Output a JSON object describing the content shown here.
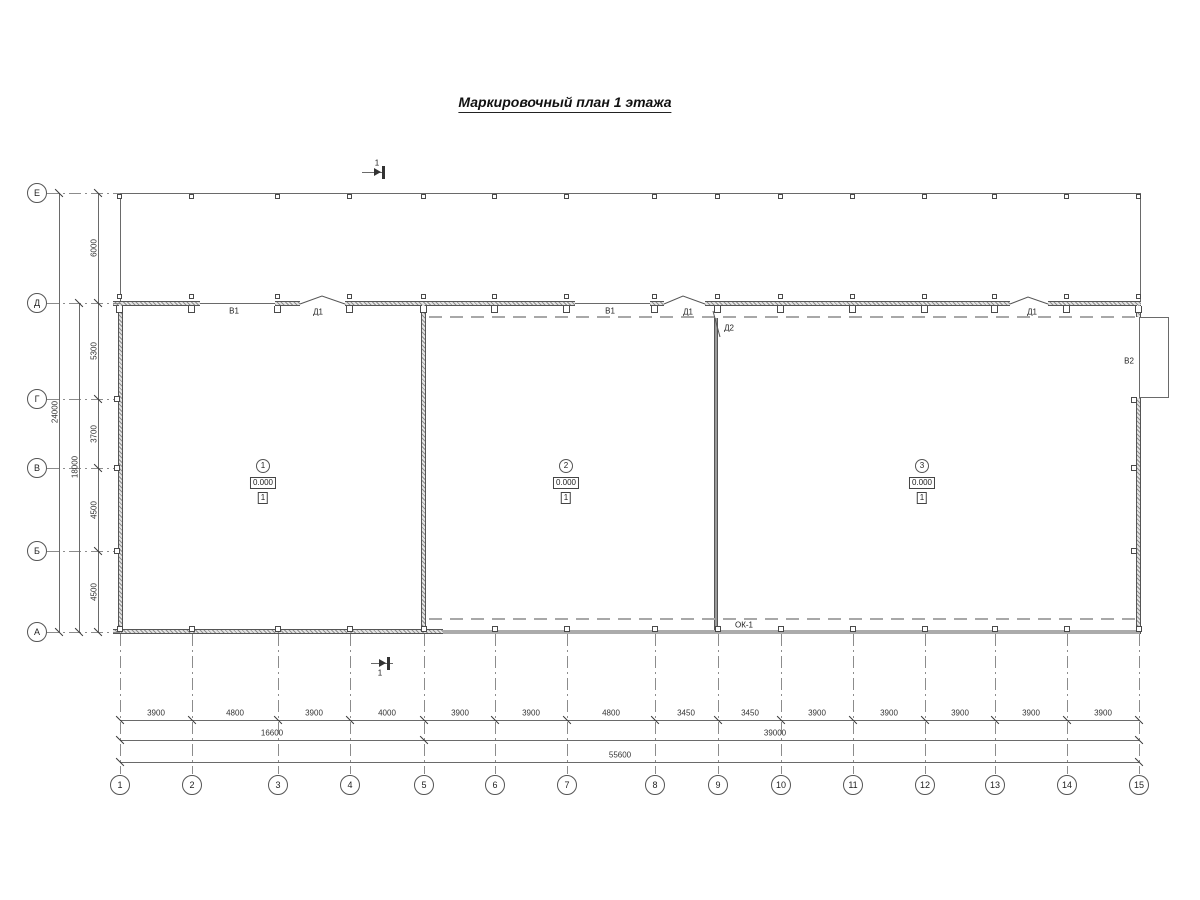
{
  "title": "Маркировочный план 1 этажа",
  "grid": {
    "rows": [
      "Е",
      "Д",
      "Г",
      "В",
      "Б",
      "А"
    ],
    "cols": [
      "1",
      "2",
      "3",
      "4",
      "5",
      "6",
      "7",
      "8",
      "9",
      "10",
      "11",
      "12",
      "13",
      "14",
      "15"
    ]
  },
  "dims": {
    "left_segments": [
      "6000",
      "5300",
      "3700",
      "4500",
      "4500"
    ],
    "left_totals": [
      "18000",
      "24000"
    ],
    "bottom_segments": [
      "3900",
      "4800",
      "3900",
      "4000",
      "3900",
      "3900",
      "4800",
      "3450",
      "3450",
      "3900",
      "3900",
      "3900",
      "3900",
      "3900"
    ],
    "bottom_subtotals": [
      "16600",
      "39000"
    ],
    "bottom_total": "55600"
  },
  "labels": {
    "gate1": "В1",
    "door1": "Д1",
    "gate2": "В1",
    "door2": "Д1",
    "door3": "Д2",
    "door4": "Д1",
    "gate3": "В2",
    "window": "ОК-1"
  },
  "section": {
    "mark": "1"
  },
  "rooms": [
    {
      "number": "1",
      "elevation": "0.000",
      "floor_type": "1"
    },
    {
      "number": "2",
      "elevation": "0.000",
      "floor_type": "1"
    },
    {
      "number": "3",
      "elevation": "0.000",
      "floor_type": "1"
    }
  ],
  "colors": {
    "line": "#555555",
    "wall_fill": "#e3e3e3",
    "gray_wall": "#ababab"
  }
}
